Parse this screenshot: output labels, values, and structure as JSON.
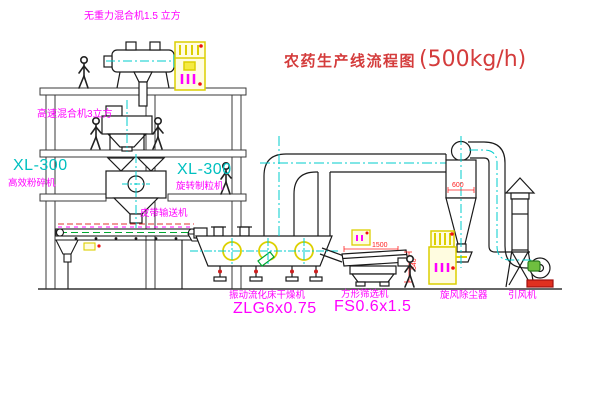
{
  "title": {
    "name": "农药生产线流程图",
    "capacity": "(500kg/h)"
  },
  "labels": {
    "gravity_mixer": "无重力混合机1.5 立方",
    "high_speed_mixer": "高速混合机3立方",
    "crusher_model": "XL-300",
    "crusher_name": "高效粉碎机",
    "granulator_model": "XL-300",
    "granulator_name": "旋转制粒机",
    "belt_conveyor": "皮带输送机",
    "dryer_name": "振动流化床干燥机",
    "dryer_model": "ZLG6x0.75",
    "sifter_name": "方形筛选机",
    "sifter_model": "FS0.6x1.5",
    "cyclone_name": "旋风除尘器",
    "fan_name": "引风机"
  },
  "dimensions": {
    "sifter_length": "1500",
    "sifter_height": "340",
    "cyclone_diameter": "600"
  },
  "colors": {
    "title_red": "#d43c3c",
    "label_magenta": "#ff00ff",
    "model_cyan": "#00c0c0",
    "dimension_red": "#ff2020",
    "cabinet_yellow": "#dccf00",
    "centerline_cyan": "#00cccc",
    "machine_green": "#00a830",
    "line_black": "#1a1a1a",
    "background": "#ffffff"
  }
}
